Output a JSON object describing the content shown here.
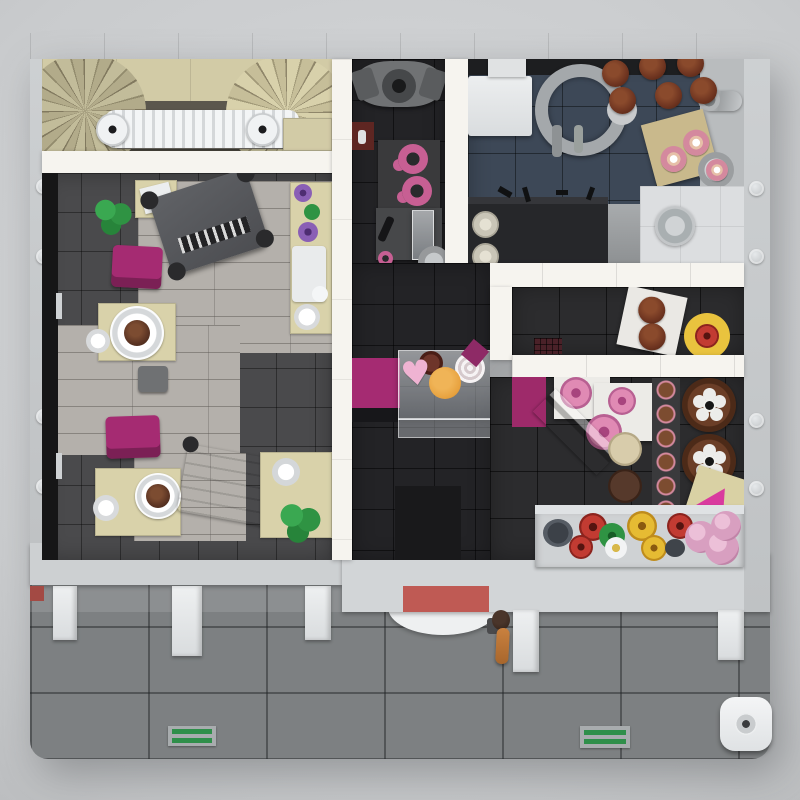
{
  "scene": {
    "title": "Top-down render of a LEGO modular bakery and cafe interior",
    "description": "Overhead cutaway view of a LEGO building: staircase hallway with white radiator, cafe with grand piano, magenta chairs, tan tables with chocolate cakes and tea set; utility room with coffee machine and pink mugs; kitchen with blue tiled floor, coiled faucet, bread buns and donut cutting board; magenta pastry display case; bakery with rose cakes, chocolate flower cakes and a window flower box; street front with white pillars, red entrance mat, pedestrian minifigure, drain grates and outdoor tables.",
    "style": "3d-render",
    "background": "#c9cbcd"
  },
  "palette": {
    "baseplate": "#c7cacc",
    "stud": "#dadde0",
    "wall_white": "#f6f4ef",
    "hallway_floor": "#5b574d",
    "stair_tan": "#d2cba6",
    "cafe_tile_dark": "#4a4a4c",
    "cafe_plank_light": "#b4b0ab",
    "utility_floor": "#232326",
    "kitchen_floor_blue": "#3d4857",
    "bakery_floor": "#2c2c2e",
    "street": "#7d8082",
    "sidewalk_highlight": "rgba(255,255,255,0.12)",
    "magenta": "#a52b72",
    "magenta_dark": "#9e2a6a",
    "pink": "#e08ab4",
    "tan_furniture": "#d9d2aa",
    "green_plant": "#2f9343",
    "cake_brown": "#5b3423",
    "bun_brown": "#6e3420",
    "mat_red": "#bf5a54",
    "drain_green": "#2f8f4a",
    "black_strip": "#161617",
    "dark_counter": "#26272a",
    "red_crate": "#5e2622",
    "orange_cookie": "#e7a13e",
    "yellow_plate": "#e9c33e",
    "board_tan": "#d9d1a4",
    "slice_pink": "#d93a9e"
  },
  "icons": {
    "heart": "♥"
  },
  "rooms": {
    "hallway": {
      "label": "staircase hallway",
      "objects": [
        "spiral-staircase-left",
        "spiral-staircase-right",
        "stair-landing",
        "white-radiator",
        "step-pad"
      ]
    },
    "cafe": {
      "label": "cafe seating room",
      "objects": [
        "potted-plant x2",
        "service-table",
        "grand-piano",
        "sideboard with purple flower vases, green teapot and tea tray",
        "white teapot and cup",
        "magenta chair x2",
        "gray stool",
        "cafe table with chocolate cake on white plate x2",
        "coffee cup x3",
        "serving-trolley",
        "table with mug and plant"
      ]
    },
    "utility": {
      "label": "coffee prep room",
      "objects": [
        "coffee-machine",
        "red-crate",
        "shelf with pink mugs x2",
        "prep-counter with glass jar and black bottle",
        "pink cup",
        "gray plate"
      ]
    },
    "kitchen": {
      "label": "kitchen with blue tile floor",
      "objects": [
        "fridge",
        "coiled-faucet sink",
        "bread-bun x6",
        "bun plate",
        "cutting-board with donut x2",
        "donut-plate",
        "meat-grinder",
        "dark counter with utensils",
        "canister x2",
        "appliance",
        "white floor corner",
        "round stool"
      ]
    },
    "entry": {
      "label": "shop entry with pastry counter",
      "objects": [
        "magenta display-counter base",
        "glass display case",
        "heart-cookie",
        "orange-cookie",
        "meringue-swirl",
        "dark-red bun",
        "magenta wedge",
        "dark floor mat"
      ]
    },
    "bakery": {
      "label": "bakery sales room",
      "objects": [
        "muffin box with muffin x2",
        "rose cake on yellow plate",
        "vent-grille",
        "magenta counter",
        "display table x2 with pink rose cake x3",
        "angled glass case",
        "cream cake",
        "brown cake",
        "cookie stack",
        "chocolate flower cake x2",
        "cake board with pink slice",
        "window flower box with red roses, yellow roses, pink carnations, leaves, white flower and pots"
      ]
    }
  },
  "street": {
    "label": "sidewalk and roadway",
    "objects": [
      "front wall left",
      "front wall right",
      "red entrance mat",
      "awning pillar x5",
      "pedestrian minifigure",
      "outdoor semicircle table",
      "drain grate x2",
      "outdoor round white table",
      "left red accent"
    ]
  }
}
